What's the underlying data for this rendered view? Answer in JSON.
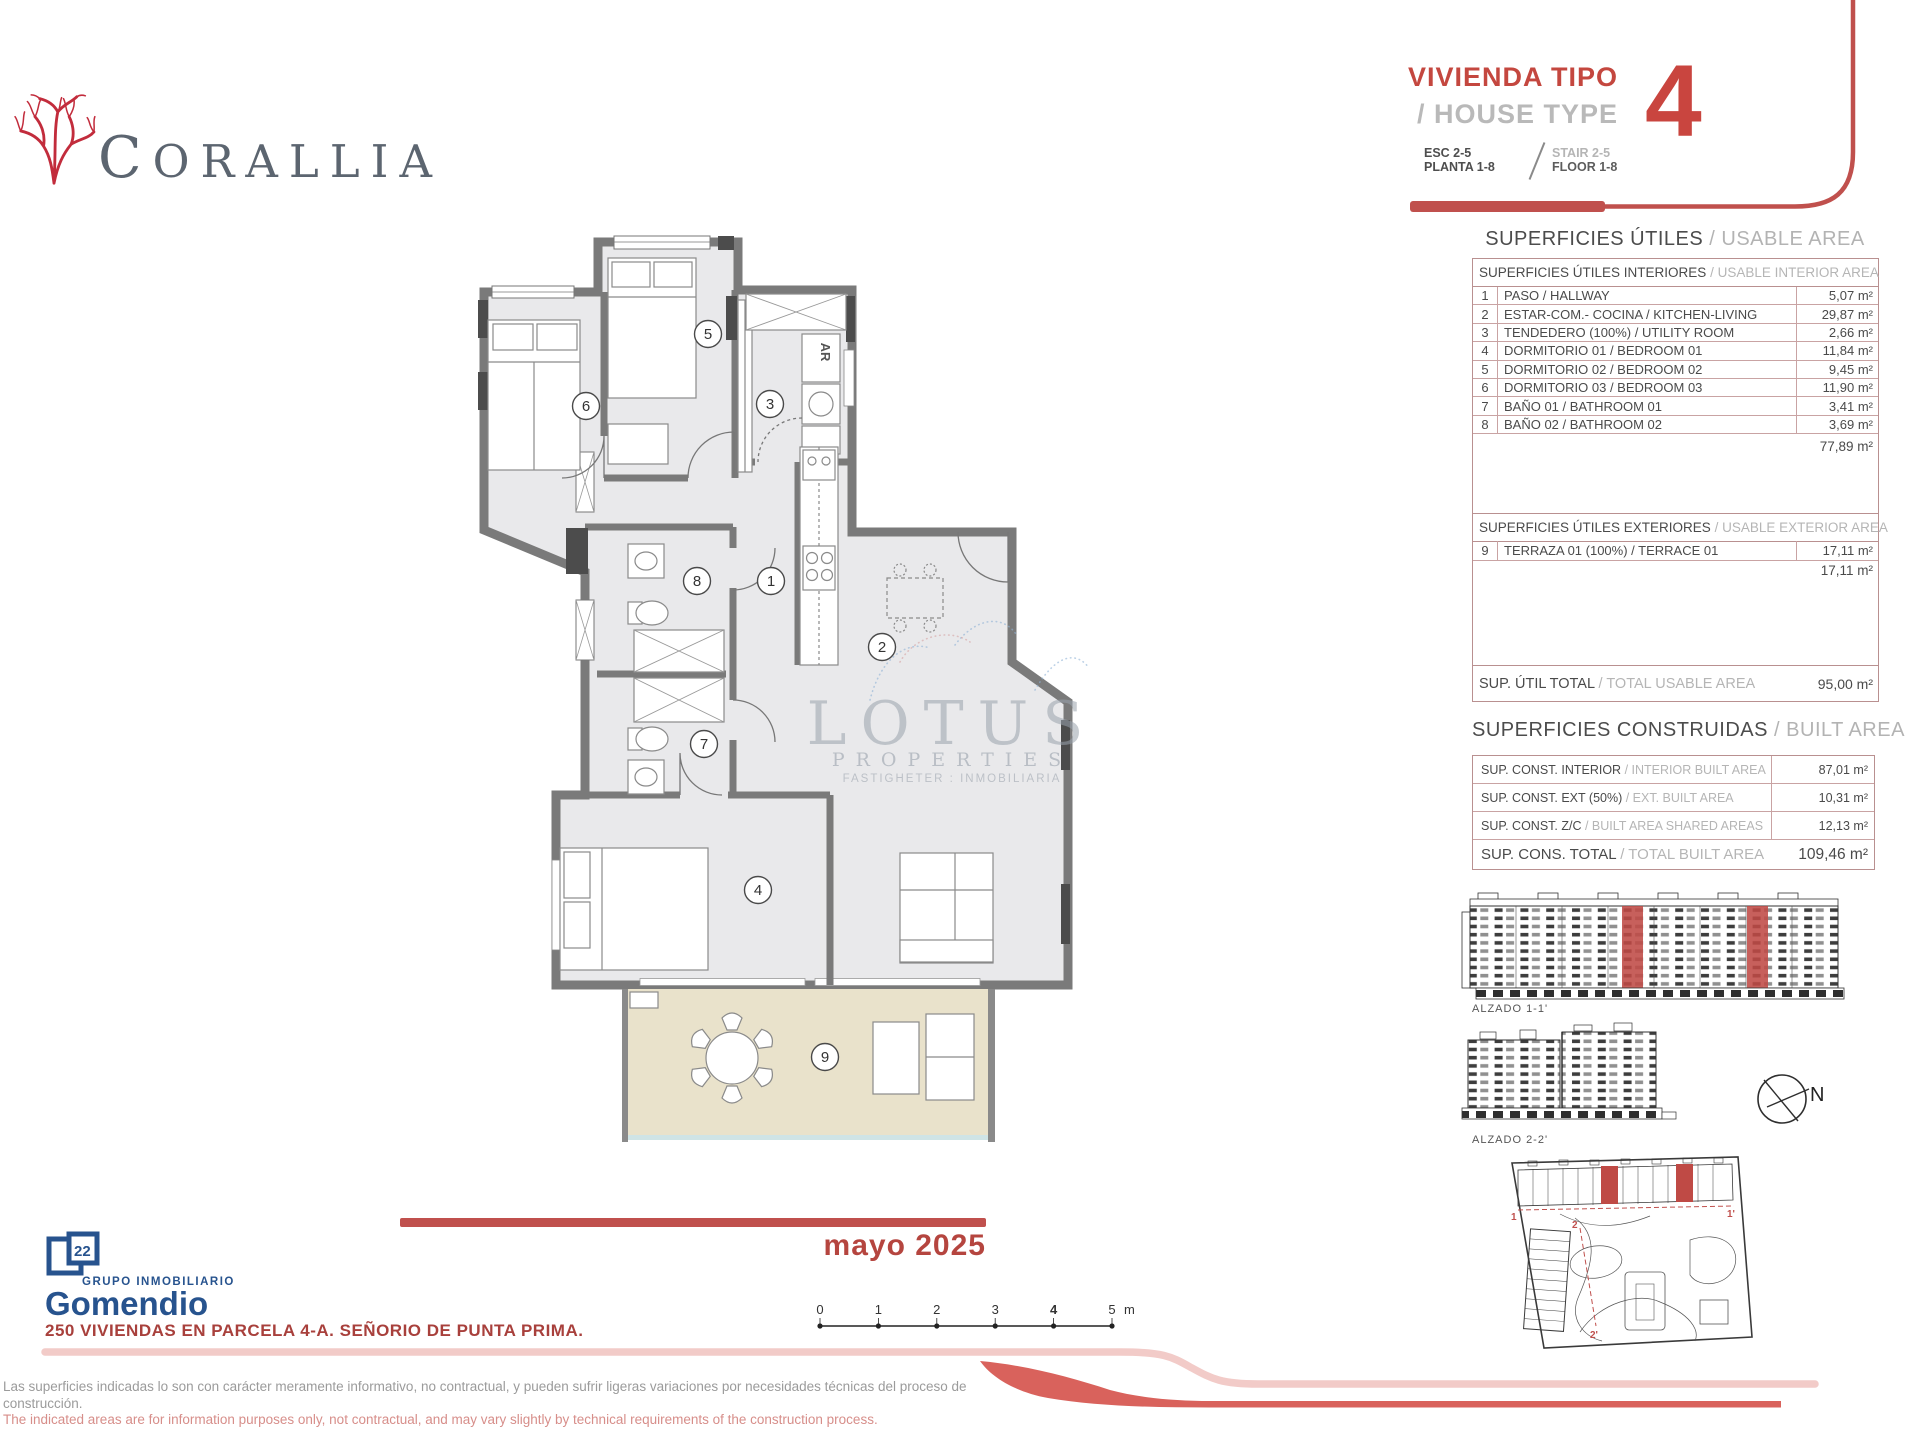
{
  "logo": {
    "name": "CORALLIA"
  },
  "header": {
    "title_es": "VIVIENDA TIPO",
    "title_en": "/ HOUSE TYPE",
    "type_number": "4",
    "esc": "ESC 2-5",
    "planta": "PLANTA 1-8",
    "stair": "STAIR 2-5",
    "floor": "FLOOR 1-8"
  },
  "usable_area": {
    "section_title_es": "SUPERFICIES ÚTILES",
    "section_title_en": "/ USABLE AREA",
    "interior": {
      "header_es": "SUPERFICIES ÚTILES INTERIORES",
      "header_en": "/ USABLE INTERIOR AREA",
      "rows": [
        {
          "num": "1",
          "label": "PASO / HALLWAY",
          "area": "5,07 m²"
        },
        {
          "num": "2",
          "label": "ESTAR-COM.- COCINA / KITCHEN-LIVING",
          "area": "29,87 m²"
        },
        {
          "num": "3",
          "label": "TENDEDERO (100%) / UTILITY ROOM",
          "area": "2,66 m²"
        },
        {
          "num": "4",
          "label": "DORMITORIO 01 / BEDROOM 01",
          "area": "11,84 m²"
        },
        {
          "num": "5",
          "label": "DORMITORIO 02 / BEDROOM 02",
          "area": "9,45 m²"
        },
        {
          "num": "6",
          "label": "DORMITORIO 03 / BEDROOM 03",
          "area": "11,90 m²"
        },
        {
          "num": "7",
          "label": "BAÑO 01 / BATHROOM 01",
          "area": "3,41 m²"
        },
        {
          "num": "8",
          "label": "BAÑO 02 / BATHROOM 02",
          "area": "3,69 m²"
        }
      ],
      "total": "77,89 m²"
    },
    "exterior": {
      "header_es": "SUPERFICIES ÚTILES EXTERIORES",
      "header_en": "/ USABLE EXTERIOR AREA",
      "rows": [
        {
          "num": "9",
          "label": "TERRAZA 01 (100%) / TERRACE 01",
          "area": "17,11 m²"
        }
      ],
      "total": "17,11 m²"
    },
    "grand_total": {
      "label_es": "SUP. ÚTIL TOTAL",
      "label_en": "/ TOTAL USABLE AREA",
      "value": "95,00 m²"
    }
  },
  "built_area": {
    "section_title_es": "SUPERFICIES CONSTRUIDAS",
    "section_title_en": "/ BUILT AREA",
    "rows": [
      {
        "label_es": "SUP. CONST. INTERIOR",
        "label_en": "/ INTERIOR BUILT AREA",
        "value": "87,01 m²"
      },
      {
        "label_es": "SUP. CONST. EXT (50%)",
        "label_en": "/ EXT. BUILT AREA",
        "value": "10,31 m²"
      },
      {
        "label_es": "SUP. CONST. Z/C",
        "label_en": "/ BUILT AREA SHARED AREAS",
        "value": "12,13 m²"
      },
      {
        "label_es": "SUP. CONS. TOTAL",
        "label_en": "/ TOTAL BUILT AREA",
        "value": "109,46 m²"
      }
    ]
  },
  "plan": {
    "labels": [
      "1",
      "2",
      "3",
      "4",
      "5",
      "6",
      "7",
      "8",
      "9"
    ],
    "ar": "AR"
  },
  "watermark": {
    "line1": "LOTUS",
    "line2": "PROPERTIES",
    "line3": "FASTIGHETER : INMOBILIARIA"
  },
  "drawings": {
    "alzado1": "ALZADO 1-1'",
    "alzado2": "ALZADO 2-2'",
    "north": "N",
    "site_marks": {
      "m1": "1",
      "m1p": "1'",
      "m2": "2",
      "m2p": "2'"
    }
  },
  "scalebar": {
    "ticks": [
      "0",
      "1",
      "2",
      "3",
      "4",
      "5"
    ],
    "unit": "m"
  },
  "footer": {
    "date": "mayo 2025",
    "gomendio_top": "GRUPO INMOBILIARIO",
    "gomendio_name": "Gomendio",
    "project": "250 VIVIENDAS EN PARCELA 4-A. SEÑORIO DE PUNTA PRIMA.",
    "disclaimer_es_1": "Las superficies indicadas lo son con carácter meramente informativo, no contractual, y pueden sufrir ligeras variaciones por necesidades técnicas del proceso de",
    "disclaimer_es_2": "construcción.",
    "disclaimer_en": "The indicated areas are for information purposes only, not contractual, and may vary slightly by technical requirements of the construction process."
  },
  "colors": {
    "accent_red": "#c0504d",
    "bright_red": "#c9453f",
    "pink_band": "#f2cbc8",
    "salmon": "#d9625c",
    "navy": "#27538e",
    "slate": "#5c6570",
    "coral": "#c22c3c",
    "wall_gray": "#7a7a7a",
    "floor_gray": "#e9e9eb",
    "terrace_beige": "#e9e2cb",
    "table_border": "#b99090"
  }
}
